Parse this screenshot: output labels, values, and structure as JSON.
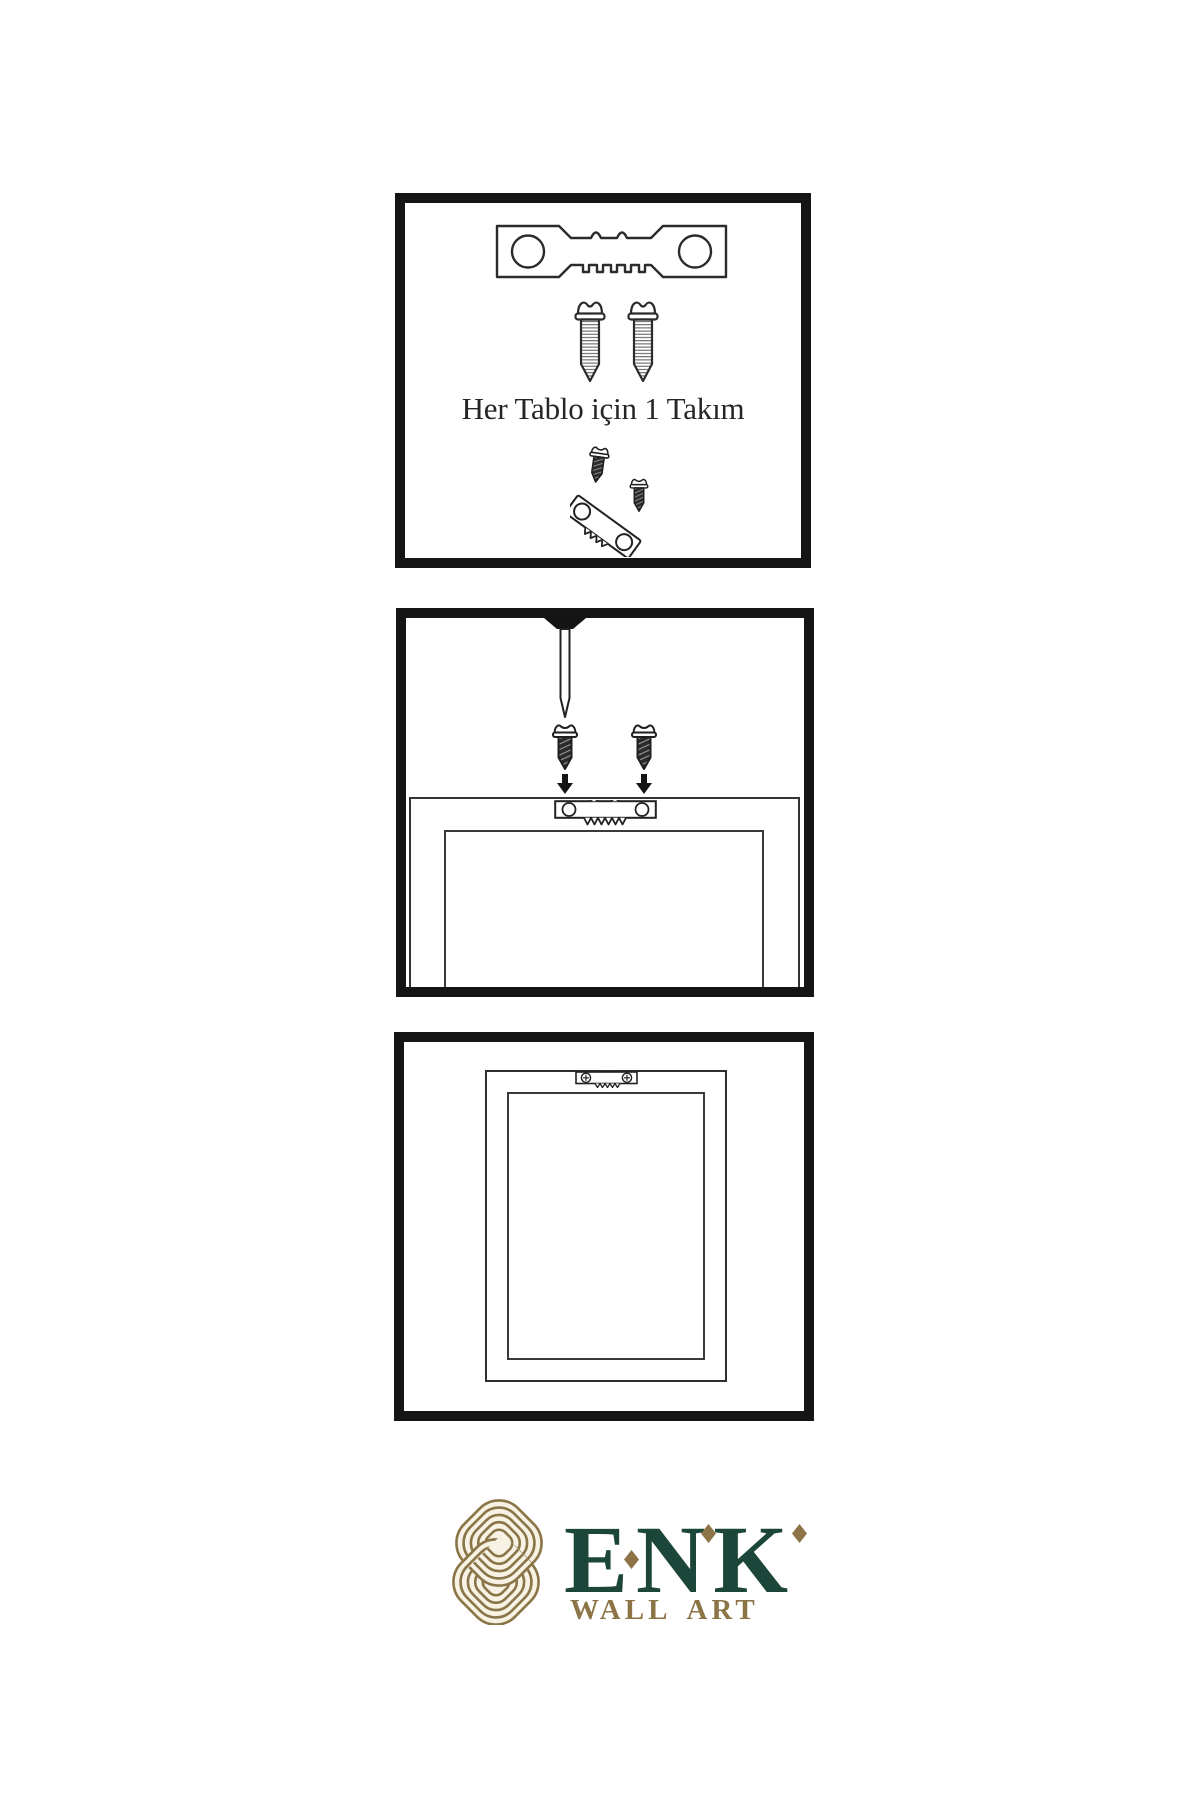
{
  "document": {
    "kind": "wall-art hanging instruction sheet",
    "background": "#ffffff"
  },
  "colors": {
    "panel_border": "#151515",
    "line": "#2b2b2b",
    "brand_green": "#1c4639",
    "brand_gold": "#8c7446",
    "knot_gold": "#8a7548",
    "knot_cream": "#f7f2e3"
  },
  "icons": {
    "sawtooth_hanger": "svg-shape",
    "screw": "svg-shape",
    "nail": "svg-shape",
    "arrow_down": "svg-shape",
    "knot_logo": "svg-shape",
    "diamond_accent": "css-diamond"
  },
  "panels": {
    "kit": {
      "caption": "Her Tablo için 1 Takım"
    },
    "mounting": {},
    "hung": {}
  },
  "brand": {
    "name": "ENK",
    "subtitle": "WALL ART"
  }
}
